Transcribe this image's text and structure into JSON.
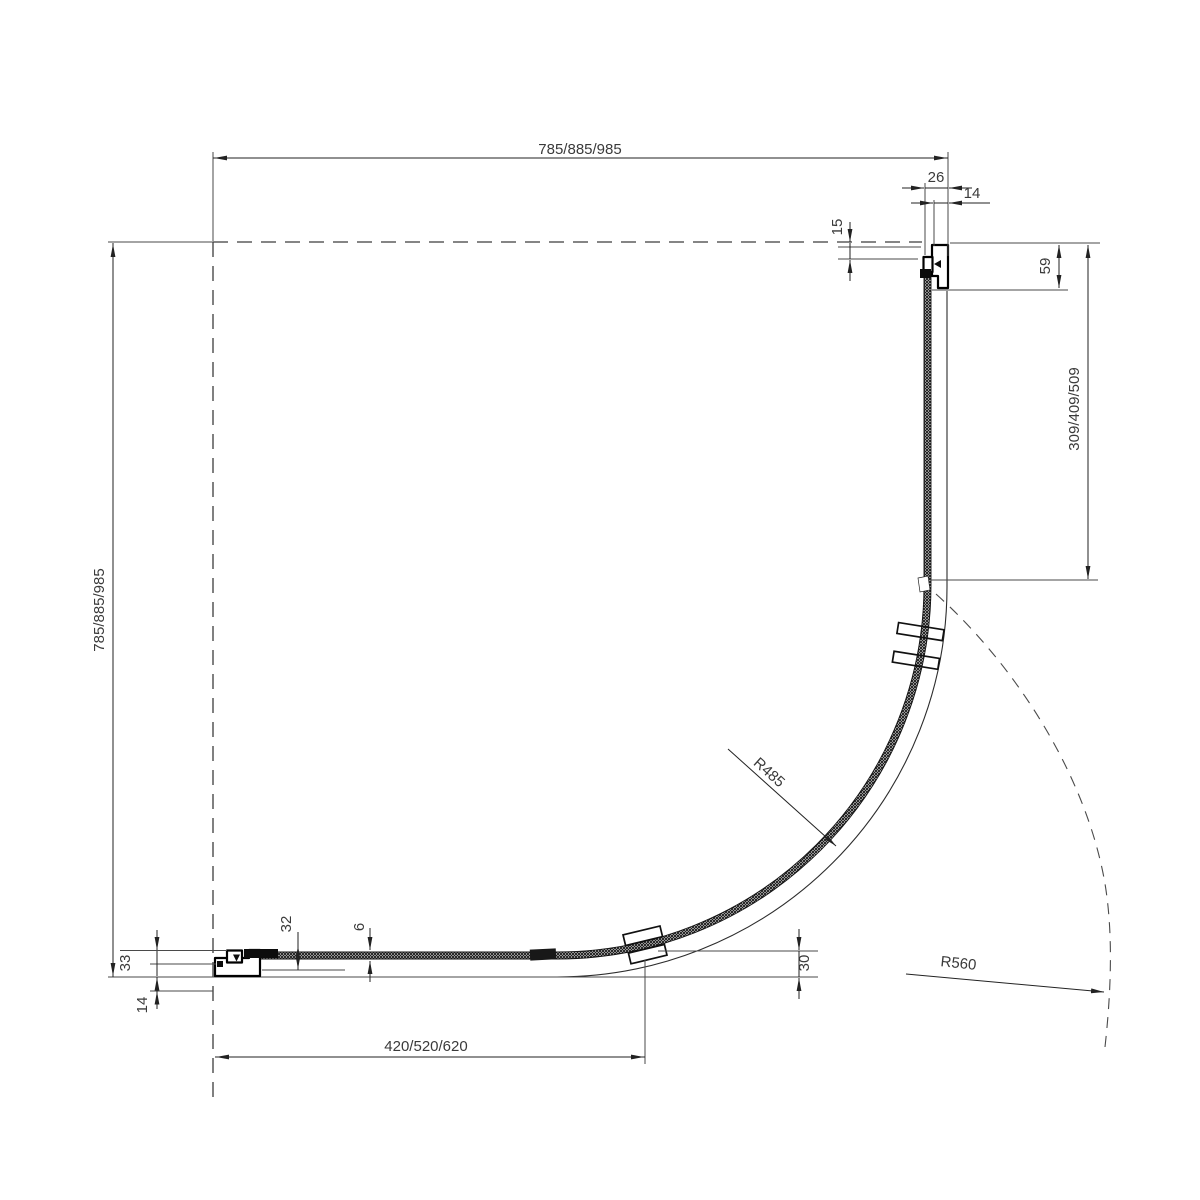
{
  "drawing": {
    "dimensions": {
      "overall_width": "785/885/985",
      "overall_depth": "785/885/985",
      "wall_profile_width": "26",
      "wall_profile_inset_top": "14",
      "wall_clearance": "15",
      "profile_depth": "59",
      "fixed_segment_length": "309/409/509",
      "door_opening_width": "420/520/620",
      "bracket_offset": "30",
      "bottom_profile_assembly": "32",
      "glass_thickness": "6",
      "bottom_profile_total": "33",
      "wall_profile_inset_bottom": "14",
      "glass_radius": "R485",
      "door_swing_radius": "R560"
    }
  }
}
